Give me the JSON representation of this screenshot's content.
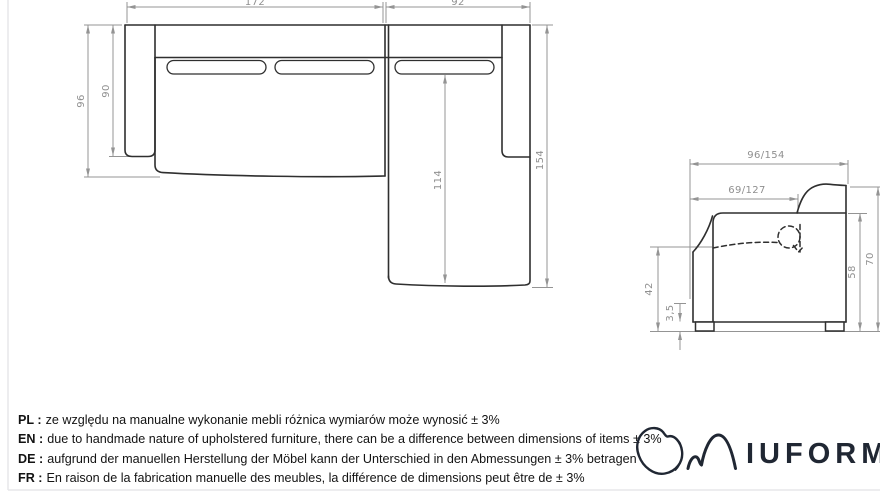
{
  "top_view": {
    "dims": {
      "width_left": "172",
      "width_right": "92",
      "depth_total": "96",
      "depth_arm": "90",
      "chaise_length_inner": "114",
      "chaise_length_total": "154"
    }
  },
  "side_view": {
    "dims": {
      "depth_total": "96/154",
      "seat_depth": "69/127",
      "seat_height": "42",
      "leg_height": "3,5",
      "body_height": "58",
      "total_height": "70"
    }
  },
  "notes": {
    "lines": [
      {
        "label": "PL :",
        "text": "ze względu na manualne wykonanie mebli różnica wymiarów może wynosić ± 3%"
      },
      {
        "label": "EN :",
        "text": "due to handmade nature of upholstered furniture, there can be a difference between dimensions of items ± 3%"
      },
      {
        "label": "DE :",
        "text": "aufgrund der manuellen Herstellung der Möbel kann der Unterschied in den Abmessungen ± 3% betragen"
      },
      {
        "label": "FR :",
        "text": "En raison de la fabrication manuelle des meubles, la différence de dimensions peut être de ± 3%"
      }
    ]
  },
  "logo": {
    "wordmark": "IUFORM",
    "registered": "®"
  },
  "colors": {
    "object_line": "#2f2f2f",
    "dimension_line": "#949494",
    "dimension_text": "#8f8f8f",
    "note_text": "#131313",
    "logo": "#202733",
    "frame": "#e7e7ea"
  }
}
